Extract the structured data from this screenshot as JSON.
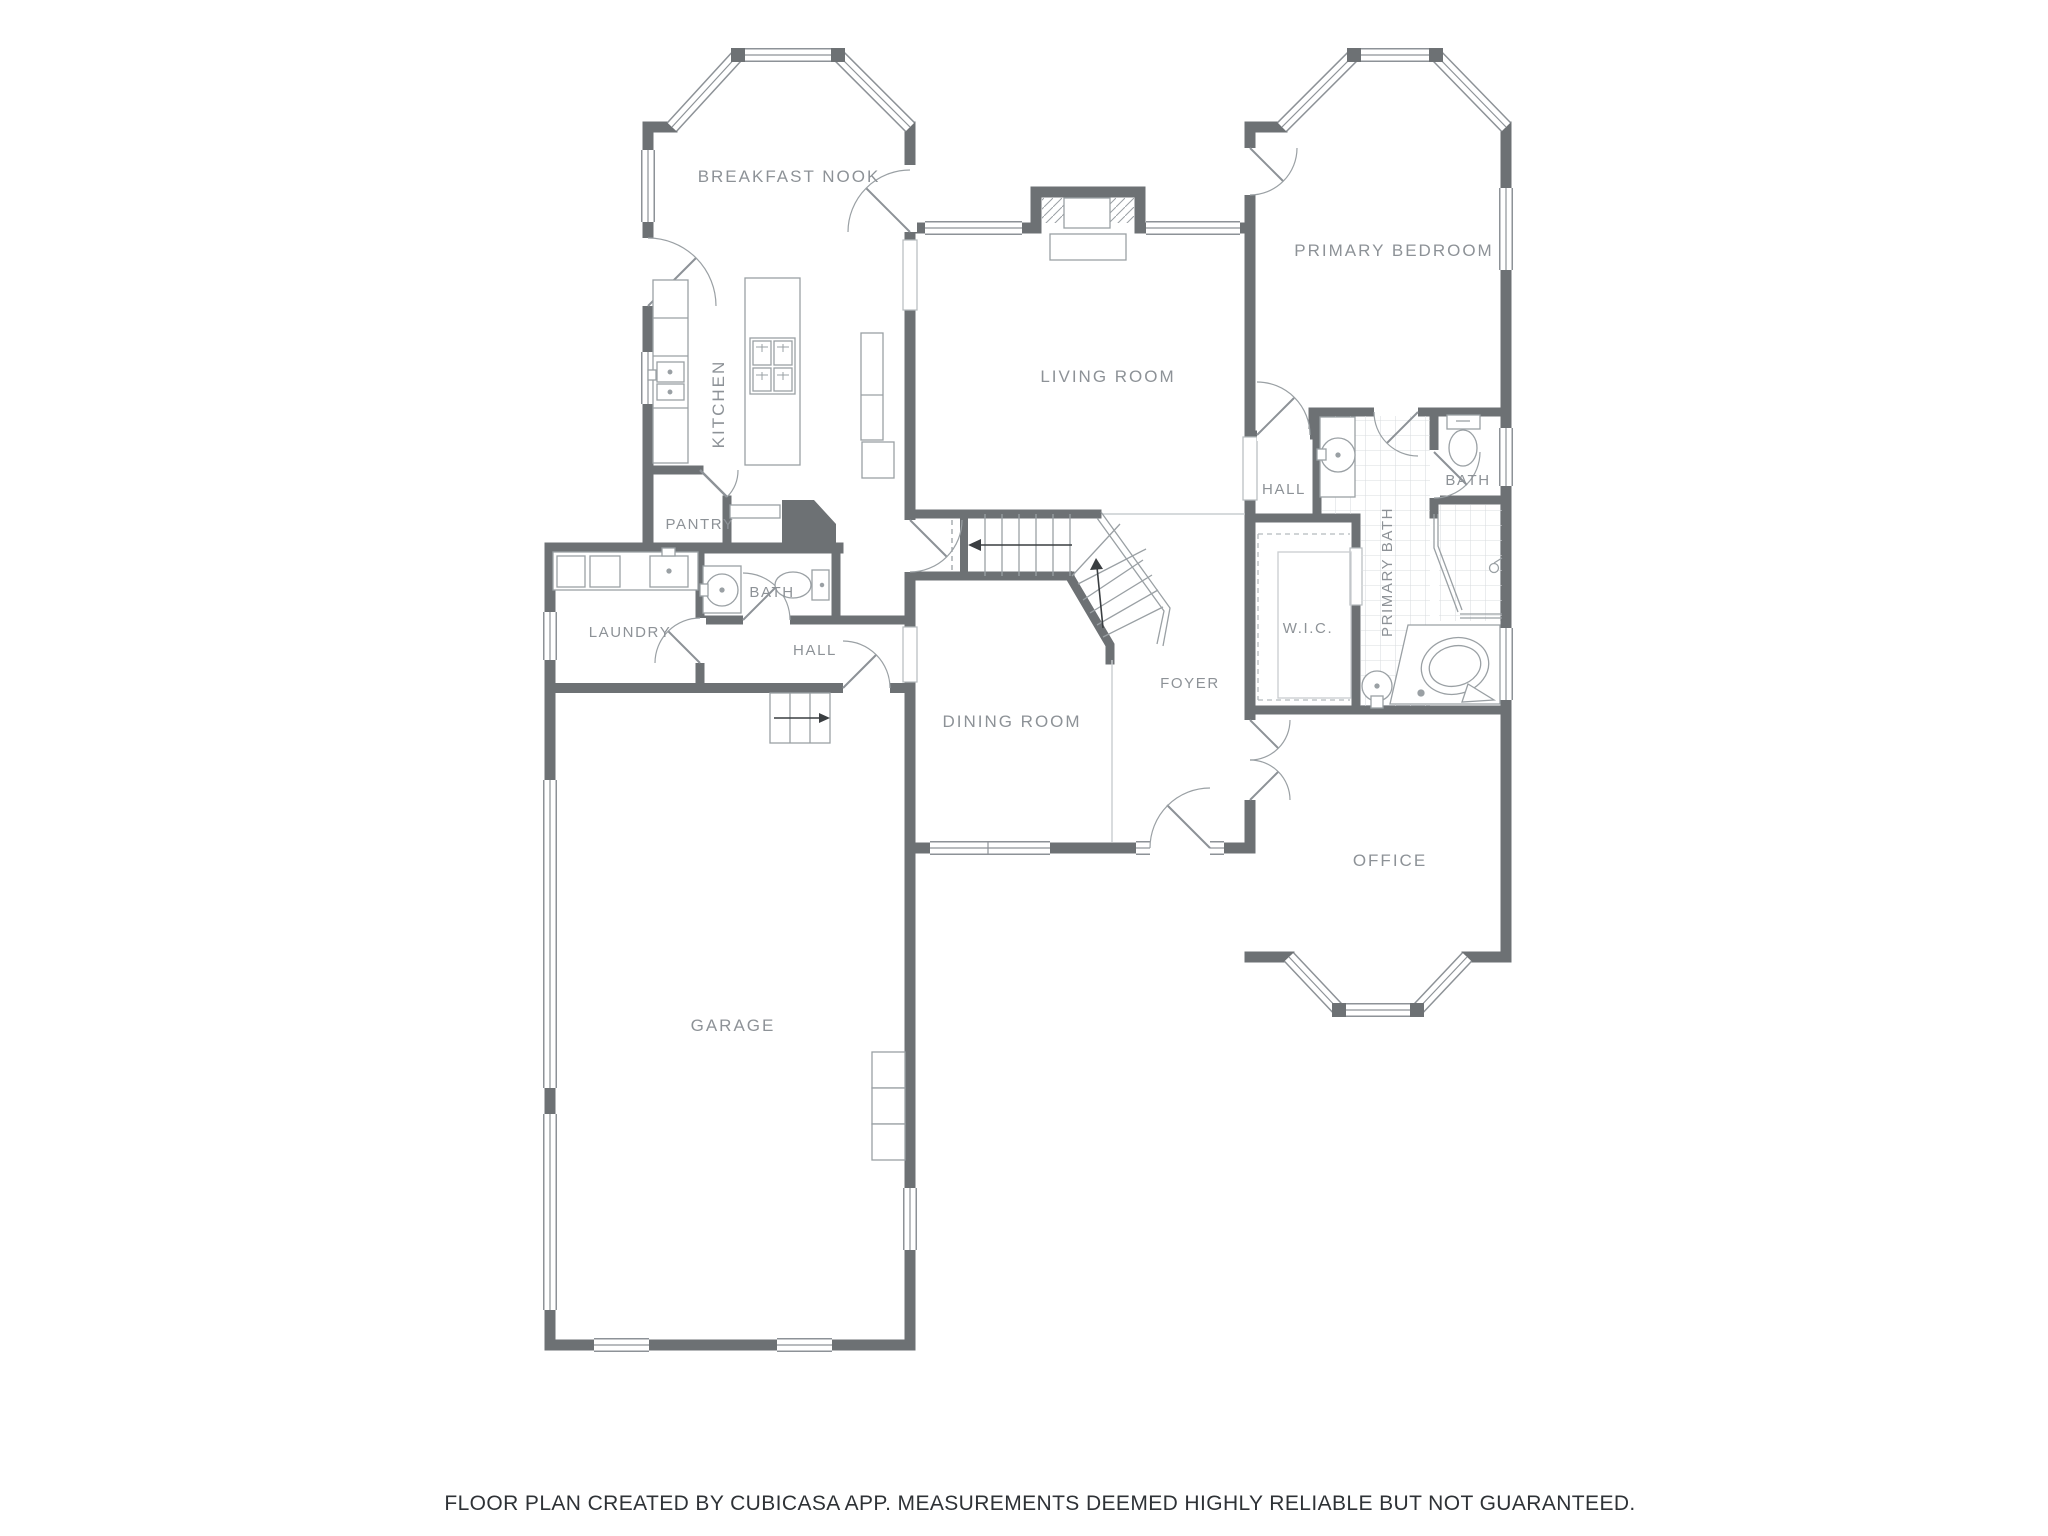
{
  "meta": {
    "app": "CubiCasa floor plan",
    "footer_text": "FLOOR PLAN CREATED BY CUBICASA APP. MEASUREMENTS DEEMED HIGHLY RELIABLE BUT NOT GUARANTEED."
  },
  "rooms": {
    "breakfast_nook": {
      "label": "BREAKFAST NOOK"
    },
    "kitchen": {
      "label": "KITCHEN"
    },
    "living_room": {
      "label": "LIVING ROOM"
    },
    "primary_bedroom": {
      "label": "PRIMARY BEDROOM"
    },
    "hall_right": {
      "label": "HALL"
    },
    "bath_right": {
      "label": "BATH"
    },
    "primary_bath": {
      "label": "PRIMARY BATH"
    },
    "wic": {
      "label": "W.I.C."
    },
    "pantry": {
      "label": "PANTRY"
    },
    "bath_left": {
      "label": "BATH"
    },
    "laundry": {
      "label": "LAUNDRY"
    },
    "hall_left": {
      "label": "HALL"
    },
    "foyer": {
      "label": "FOYER"
    },
    "dining_room": {
      "label": "DINING ROOM"
    },
    "office": {
      "label": "OFFICE"
    },
    "garage": {
      "label": "GARAGE"
    }
  },
  "colors": {
    "wall": "#6d7174",
    "label": "#8d9297",
    "fixture": "#9aa0a4",
    "tile_line": "#d9dcdf",
    "footer": "#2e3236",
    "floor": "#ffffff"
  }
}
